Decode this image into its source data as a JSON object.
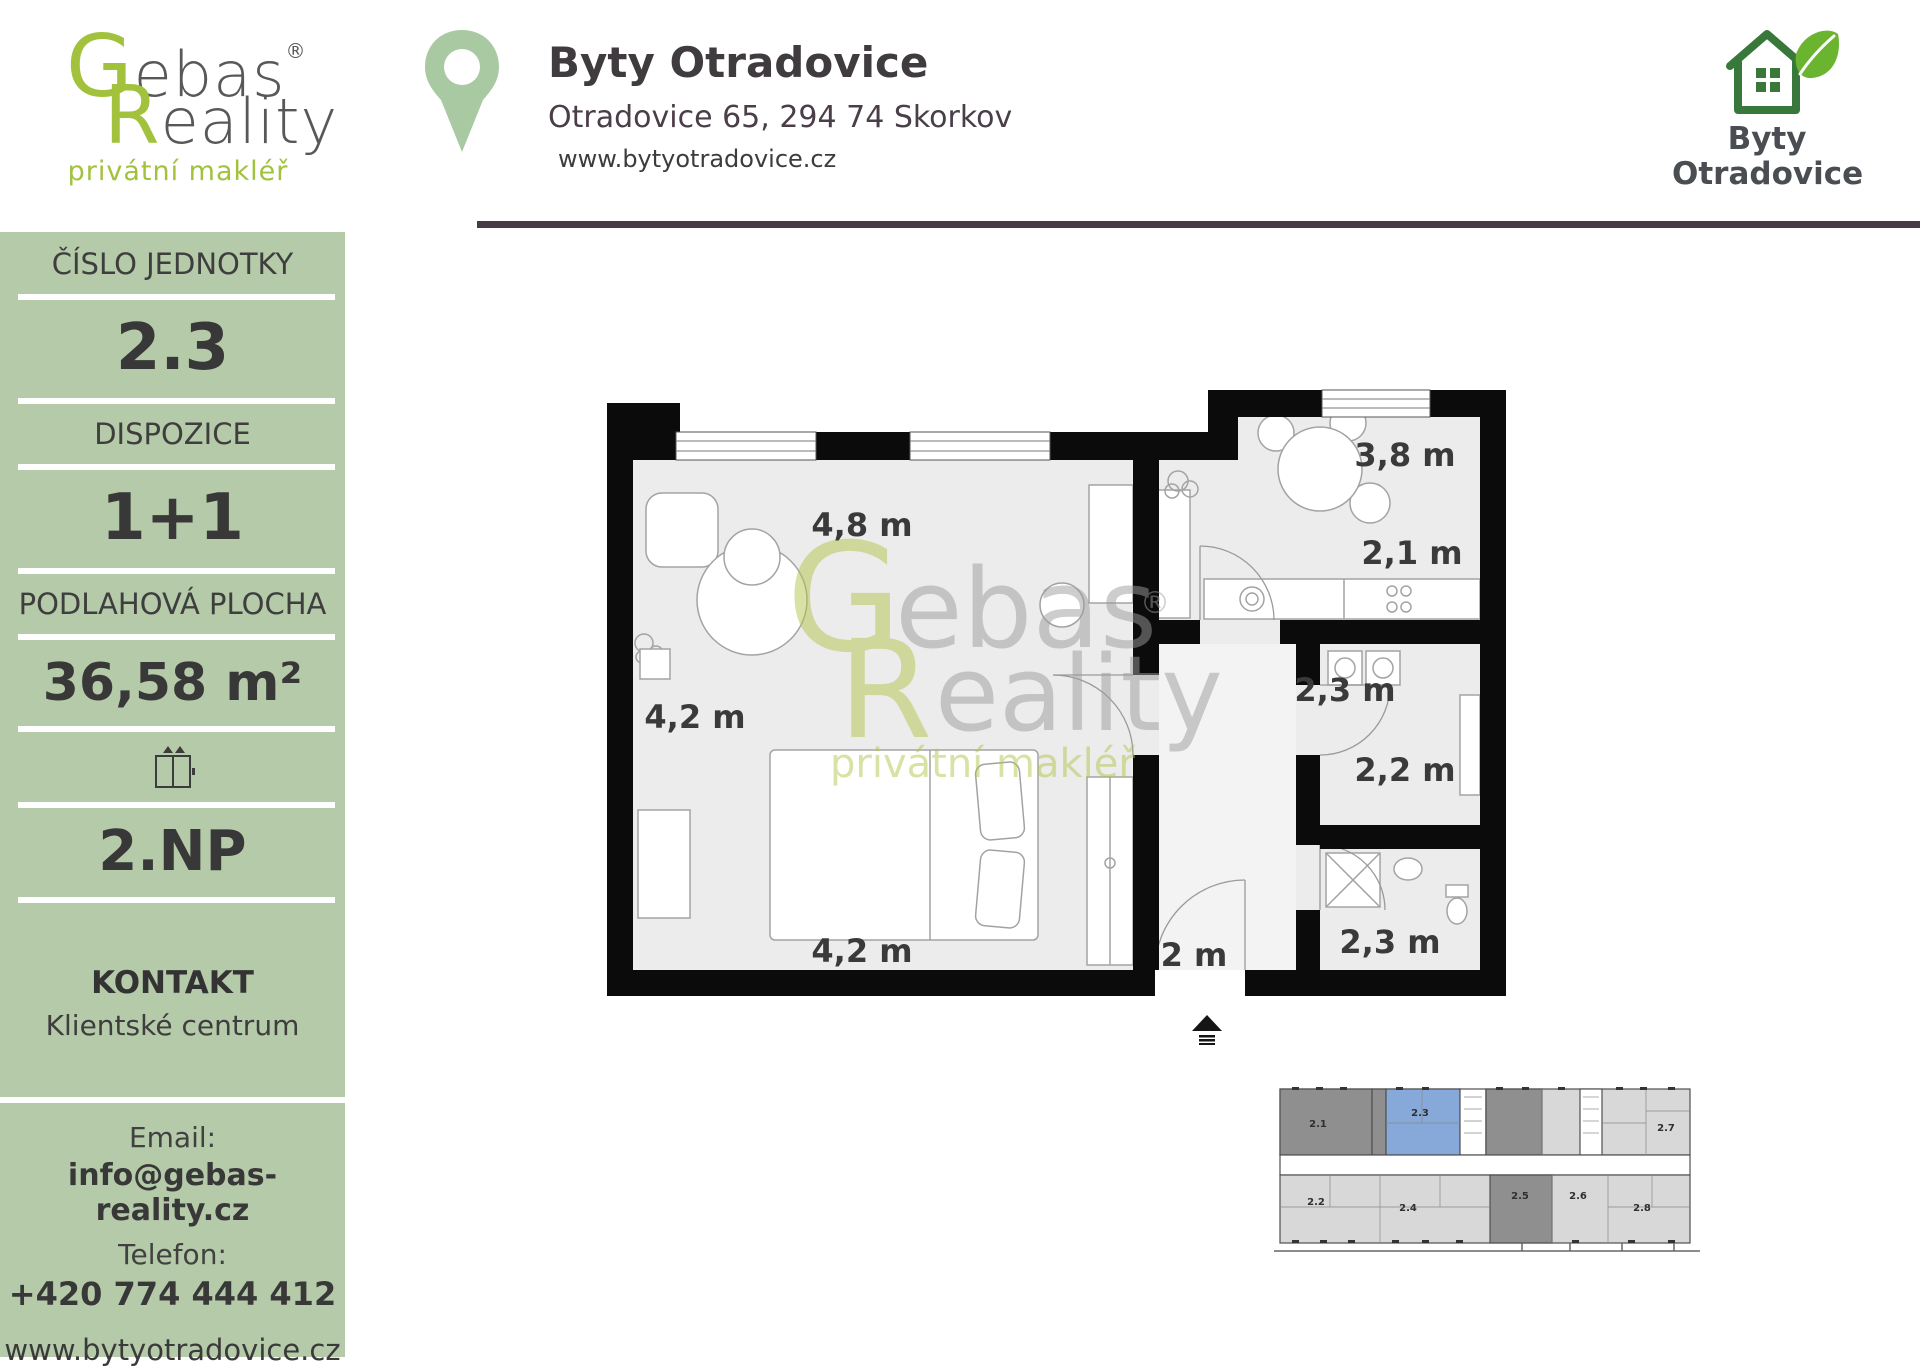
{
  "gebas_logo": {
    "g": "G",
    "rest1": "ebas",
    "reg": "®",
    "r": "R",
    "rest2": "eality",
    "tagline": "privátní makléř"
  },
  "header": {
    "title": "Byty Otradovice",
    "address": "Otradovice 65, 294 74 Skorkov",
    "website": "www.bytyotradovice.cz"
  },
  "byty_logo": {
    "line1": "Byty",
    "line2": "Otradovice"
  },
  "sidebar": {
    "unit_label": "ČÍSLO JEDNOTKY",
    "unit_value": "2.3",
    "layout_label": "DISPOZICE",
    "layout_value": "1+1",
    "area_label": "PODLAHOVÁ PLOCHA",
    "area_value": "36,58 m²",
    "floor_value": "2.NP",
    "contact_heading": "KONTAKT",
    "contact_sub": "Klientské centrum",
    "email_label": "Email:",
    "email_value": "info@gebas-reality.cz",
    "phone_label": "Telefon:",
    "phone_value": "+420 774 444 412",
    "website": "www.bytyotradovice.cz"
  },
  "floorplan": {
    "measurements": [
      {
        "text": "4,8 m"
      },
      {
        "text": "3,8 m"
      },
      {
        "text": "2,1 m"
      },
      {
        "text": "4,2 m"
      },
      {
        "text": "2,3 m"
      },
      {
        "text": "2,2 m"
      },
      {
        "text": "4,2 m"
      },
      {
        "text": "2 m"
      },
      {
        "text": "2,3 m"
      }
    ],
    "watermark": {
      "g": "G",
      "rest1": "ebas",
      "reg": "®",
      "r": "R",
      "rest2": "eality",
      "tagline": "privátní makléř"
    }
  },
  "miniplan": {
    "units": [
      {
        "id": "2.1"
      },
      {
        "id": "2.3"
      },
      {
        "id": "2.7"
      },
      {
        "id": "2.2"
      },
      {
        "id": "2.4"
      },
      {
        "id": "2.5"
      },
      {
        "id": "2.6"
      },
      {
        "id": "2.8"
      }
    ]
  },
  "colors": {
    "sidebar_green": "#b5caa8",
    "logo_green": "#a2c23e",
    "pin_green": "#a9c9a3",
    "header_rule_dark": "#473c46",
    "title_text": "#3f3b3e",
    "address_text": "#4a3e49",
    "house_green": "#38793b",
    "leaf_green": "#6ab42f",
    "byty_text": "#4a4e52",
    "wall_black": "#0b0b0b",
    "floor_gray": "#ececec",
    "furniture_stroke": "#a3a3a3",
    "measurement_text": "#3a3a3a",
    "watermark_green": "#b5c44d",
    "watermark_gray": "#9c9c9c",
    "miniplan_highlight_blue": "#86a9da",
    "miniplan_dark_gray": "#8f8f8f",
    "miniplan_light_gray": "#d8d8d8"
  }
}
